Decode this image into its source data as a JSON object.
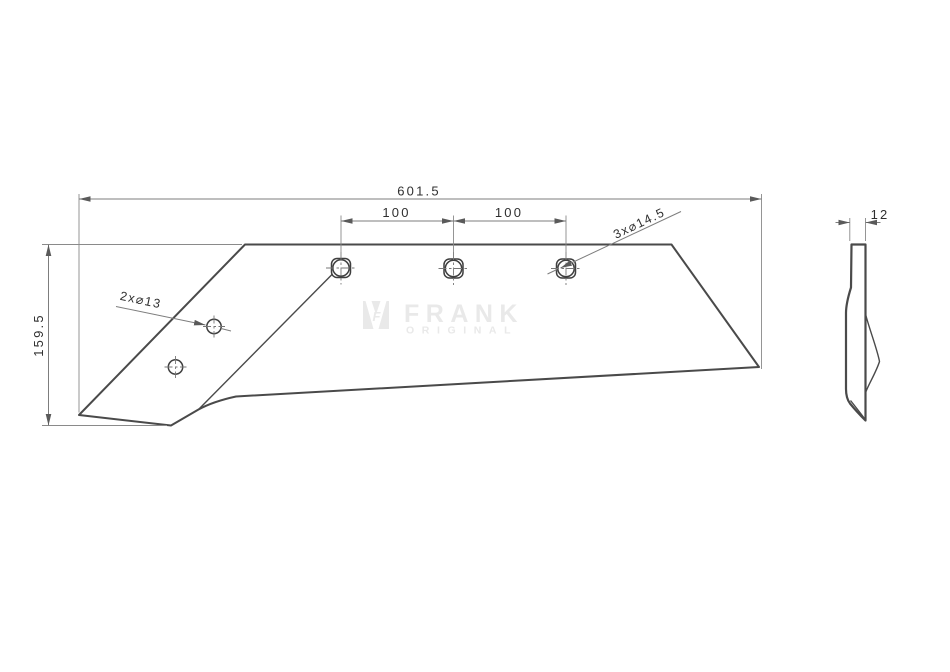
{
  "front_view": {
    "dim_overall_width": "601.5",
    "dim_hole_spacing_left": "100",
    "dim_hole_spacing_right": "100",
    "dim_height": "159.5",
    "label_small_holes": "2x⌀13",
    "label_large_holes": "3x⌀14.5"
  },
  "side_view": {
    "dim_thickness": "12"
  },
  "watermark": {
    "brand": "FRANK",
    "subtitle": "ORIGINAL",
    "monogram": "F"
  },
  "colors": {
    "background": "#ffffff",
    "part_outline": "#4a4a4a",
    "dimension_lines": "#7d7d7d",
    "dimension_text": "#2f2f2f",
    "watermark": "#e9e9e9"
  }
}
